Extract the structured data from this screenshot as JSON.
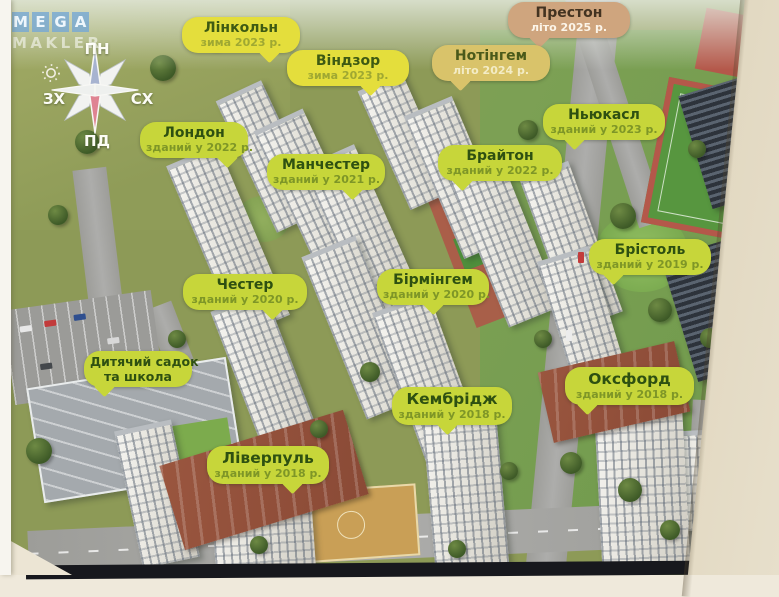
{
  "watermark": {
    "letters": [
      "M",
      "E",
      "G",
      "A"
    ],
    "line2": "MAKLER"
  },
  "compass": {
    "north": "ПН",
    "east": "СХ",
    "south": "ПД",
    "west": "ЗХ"
  },
  "bubbles": [
    {
      "id": "lincoln",
      "title": "Лінкольн",
      "subtitle": "зима 2023 р."
    },
    {
      "id": "windsor",
      "title": "Віндзор",
      "subtitle": "зима 2023 р."
    },
    {
      "id": "preston",
      "title": "Престон",
      "subtitle": "літо 2025 р."
    },
    {
      "id": "nottingham",
      "title": "Нотінгем",
      "subtitle": "літо 2024 р."
    },
    {
      "id": "newcastle",
      "title": "Ньюкасл",
      "subtitle": "зданий у 2023 р."
    },
    {
      "id": "london",
      "title": "Лондон",
      "subtitle": "зданий у 2022 р."
    },
    {
      "id": "manchester",
      "title": "Манчестер",
      "subtitle": "зданий у 2021 р."
    },
    {
      "id": "brighton",
      "title": "Брайтон",
      "subtitle": "зданий у 2022 р."
    },
    {
      "id": "bristol",
      "title": "Брістоль",
      "subtitle": "зданий у 2019 р."
    },
    {
      "id": "chester",
      "title": "Честер",
      "subtitle": "зданий у 2020 р."
    },
    {
      "id": "birmingham",
      "title": "Бірмінгем",
      "subtitle": "зданий у 2020 р."
    },
    {
      "id": "school",
      "title": "Дитячий садок",
      "subtitle": "та школа"
    },
    {
      "id": "cambridge",
      "title": "Кембрідж",
      "subtitle": "зданий у 2018 р."
    },
    {
      "id": "oxford",
      "title": "Оксфорд",
      "subtitle": "зданий у 2018 р."
    },
    {
      "id": "liverpool",
      "title": "Ліверпуль",
      "subtitle": "зданий у 2018 р."
    }
  ],
  "colors": {
    "bubble_completed": "#c7d63a",
    "bubble_winter_2023": "#e4de3c",
    "bubble_summer_2024": "#d9c36a",
    "bubble_summer_2025": "#cfa57e",
    "bubble_title_text": "#2e5011",
    "watermark_blue": "#76a8d4"
  }
}
